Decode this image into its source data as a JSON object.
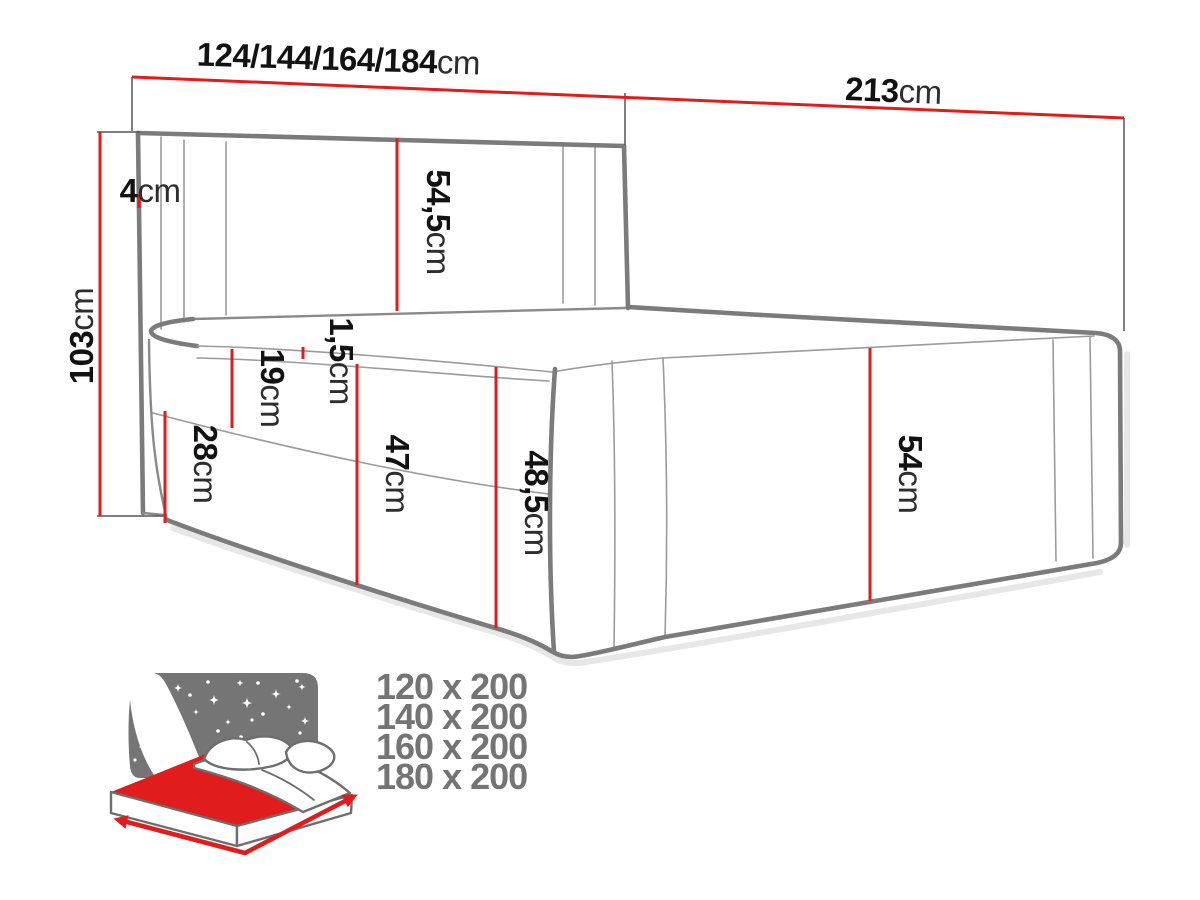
{
  "diagram": {
    "dims": {
      "width": {
        "value": "124/144/164/184",
        "unit": "cm"
      },
      "length": {
        "value": "213",
        "unit": "cm"
      },
      "height": {
        "value": "103",
        "unit": "cm"
      },
      "wing": {
        "value": "4",
        "unit": "cm"
      },
      "headboard": {
        "value": "54,5",
        "unit": "cm"
      },
      "mattress_lip": {
        "value": "1,5",
        "unit": "cm"
      },
      "upper_front": {
        "value": "19",
        "unit": "cm"
      },
      "storage": {
        "value": "28",
        "unit": "cm"
      },
      "base_front": {
        "value": "47",
        "unit": "cm"
      },
      "base_total": {
        "value": "48,5",
        "unit": "cm"
      },
      "base_side": {
        "value": "54",
        "unit": "cm"
      }
    }
  },
  "sizes": {
    "items": [
      "120 x 200",
      "140 x 200",
      "160 x 200",
      "180 x 200"
    ]
  },
  "colors": {
    "dimension_red": "#e11c1c",
    "outline_gray": "#7b7b7b",
    "thin_gray": "#9b9b9b",
    "icon_gray": "#757575",
    "text_black": "#121212",
    "size_text_gray": "#747474",
    "background": "#ffffff"
  }
}
